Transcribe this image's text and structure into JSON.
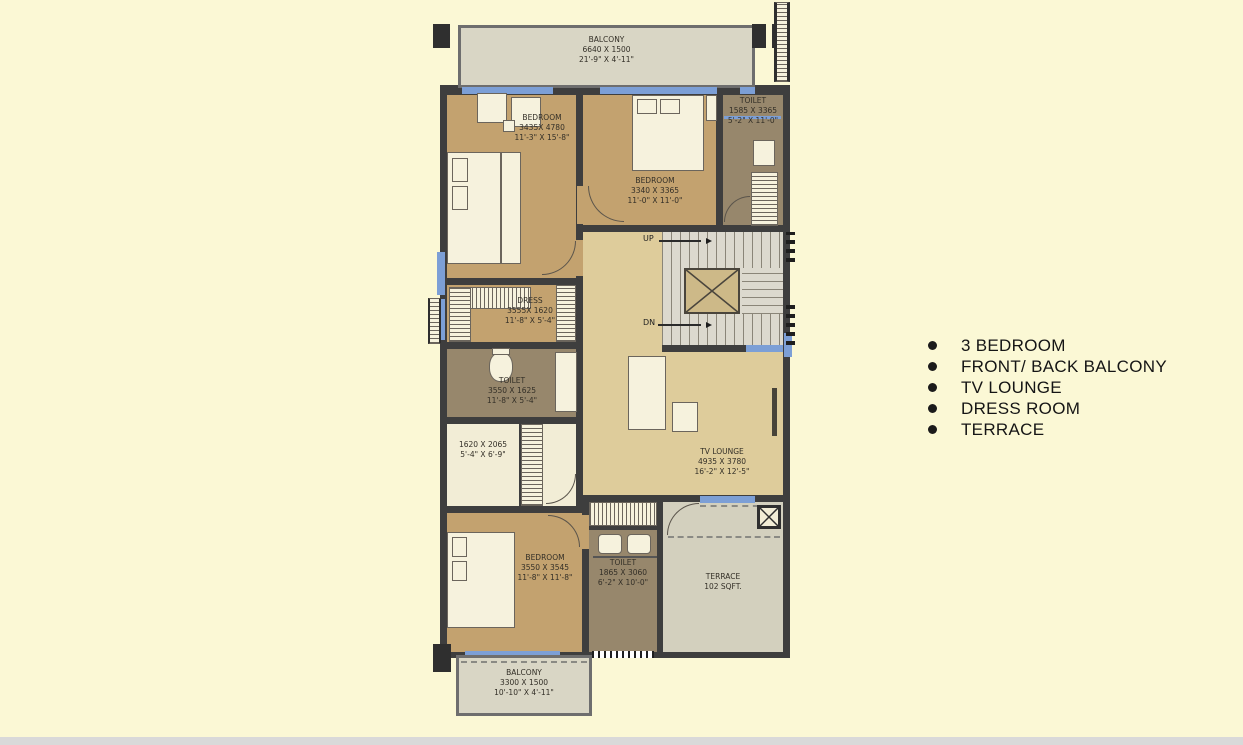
{
  "colors": {
    "bg": "#FBF8D5",
    "wall": "#3E3E3E",
    "window": "#7C9FD6",
    "room_tan": "#C3A26F",
    "room_taupe": "#97876C",
    "room_hall": "#DECC9B",
    "room_cream": "#F2EDD6",
    "fixture": "#F6F2DD",
    "balcony": "#D9D6C5",
    "stair": "#DCD9CE",
    "terrace": "#D3D0BE",
    "footer_strip": "#D9D9D9"
  },
  "features": {
    "items": [
      "3 BEDROOM",
      "FRONT/ BACK BALCONY",
      "TV LOUNGE",
      "DRESS ROOM",
      "TERRACE"
    ]
  },
  "plan": {
    "balcony_top": {
      "name": "BALCONY",
      "mm": "6640 X 1500",
      "ft": "21'-9\" X 4'-11\""
    },
    "bedroom1": {
      "name": "BEDROOM",
      "mm": "3435X 4780",
      "ft": "11'-3\" X 15'-8\""
    },
    "bedroom2": {
      "name": "BEDROOM",
      "mm": "3340 X 3365",
      "ft": "11'-0\" X 11'-0\""
    },
    "toilet_top": {
      "name": "TOILET",
      "mm": "1585 X 3365",
      "ft": "5'-2\" X 11'-0\""
    },
    "dress": {
      "name": "DRESS",
      "mm": "3555X 1620",
      "ft": "11'-8\" X 5'-4\""
    },
    "toilet_mid": {
      "name": "TOILET",
      "mm": "3550 X 1625",
      "ft": "11'-8\" X 5'-4\""
    },
    "store": {
      "mm": "1620 X 2065",
      "ft": "5'-4\" X 6'-9\""
    },
    "bedroom3": {
      "name": "BEDROOM",
      "mm": "3550 X 3545",
      "ft": "11'-8\" X 11'-8\""
    },
    "toilet_bottom": {
      "name": "TOILET",
      "mm": "1865 X 3060",
      "ft": "6'-2\" X 10'-0\""
    },
    "tv_lounge": {
      "name": "TV LOUNGE",
      "mm": "4935 X 3780",
      "ft": "16'-2\" X 12'-5\""
    },
    "terrace": {
      "name": "TERRACE",
      "area": "102 SQFT."
    },
    "balcony_bottom": {
      "name": "BALCONY",
      "mm": "3300 X 1500",
      "ft": "10'-10\" X 4'-11\""
    },
    "stairs": {
      "up": "UP",
      "dn": "DN"
    }
  }
}
